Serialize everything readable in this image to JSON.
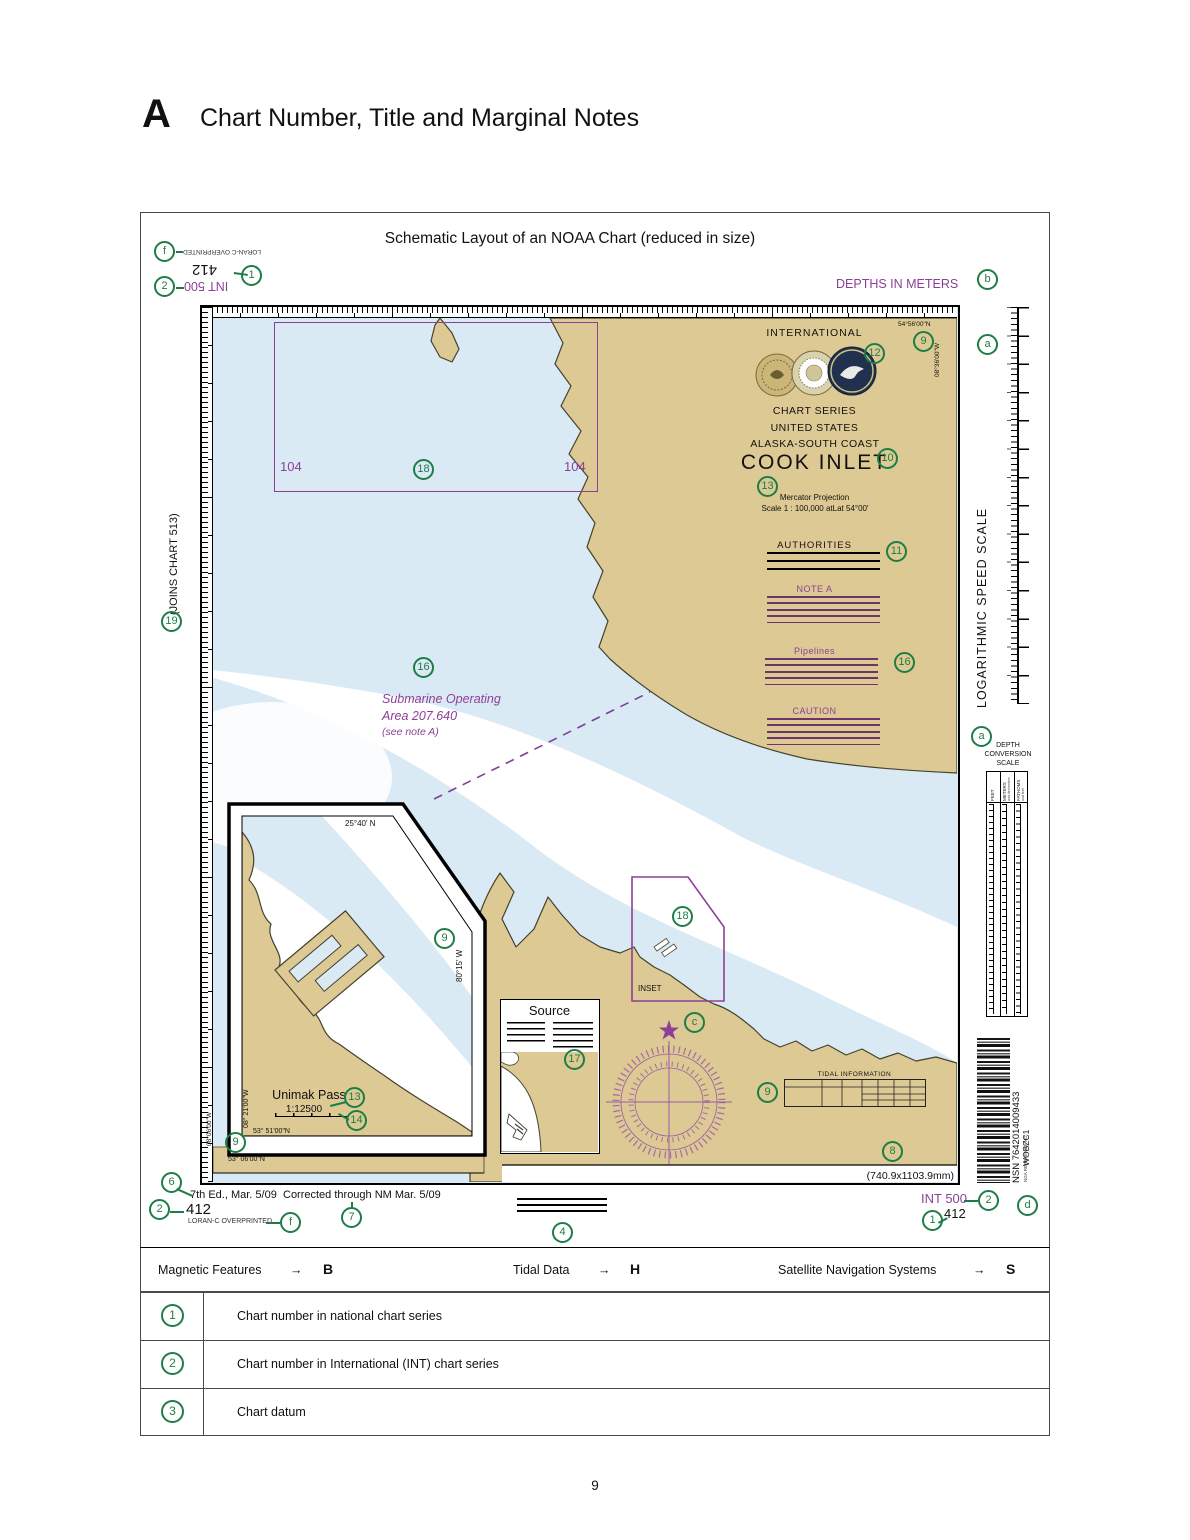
{
  "colors": {
    "green": "#1e7d46",
    "purple": "#8d3f97",
    "note_line": "#6d3468",
    "land": "#ddc994",
    "water": "#d9eaf4"
  },
  "header": {
    "section_letter": "A",
    "section_title": "Chart Number, Title and Marginal Notes"
  },
  "figure": {
    "title": "Schematic Layout of an NOAA Chart (reduced in size)"
  },
  "callouts": {
    "f": "f",
    "b": "b",
    "a": "a",
    "c": "c",
    "d": "d",
    "n1": "1",
    "n2": "2",
    "n4": "4",
    "n6": "6",
    "n7": "7",
    "n8": "8",
    "n9": "9",
    "n10": "10",
    "n11": "11",
    "n12": "12",
    "n13": "13",
    "n14": "14",
    "n16": "16",
    "n17": "17",
    "n18": "18",
    "n19": "19"
  },
  "top_left": {
    "loran": "LORAN-C OVERPRINTED",
    "chart_number": "412",
    "int_number": "INT 500"
  },
  "top_right": {
    "depths": "DEPTHS IN METERS"
  },
  "left_margin": {
    "joins": "(JOINS CHART 513)"
  },
  "right_margin": {
    "speed_scale": "LOGARITHMIC SPEED SCALE",
    "depth_scale_line1": "DEPTH",
    "depth_scale_line2": "CONVERSION",
    "depth_scale_line3": "SCALE",
    "col_feet": "FEET",
    "col_meters": "METERS",
    "col_meters_sub": "and decimeters",
    "col_fathoms": "FATHOMS",
    "col_fathoms_sub": "and feet"
  },
  "title_block": {
    "international": "INTERNATIONAL",
    "lat_top": "54°56'00\"N",
    "lon_right": "08°36'00\"W",
    "chart_series": "CHART SERIES",
    "united_states": "UNITED STATES",
    "region": "ALASKA-SOUTH COAST",
    "chart_title": "COOK INLET",
    "projection": "Mercator Projection",
    "scale": "Scale 1 : 100,000 atLat 54°00'"
  },
  "notes": {
    "authorities": "AUTHORITIES",
    "note_a": "NOTE A",
    "pipelines": "Pipelines",
    "caution": "CAUTION"
  },
  "map": {
    "neatline_number": "104",
    "submarine_line1": "Submarine Operating",
    "submarine_line2": "Area  207.640",
    "submarine_line3": "(see note A)",
    "inset_frame_label": "INSET",
    "source_title": "Source",
    "tidal_title": "TIDAL INFORMATION",
    "dimensions": "(740.9x1103.9mm)"
  },
  "inset": {
    "lat_top": "25°40' N",
    "lon_right": "80°15' W",
    "name": "Unimak Pass",
    "scale": "1:12500",
    "lon_left": "08° 21'00\"W",
    "lat_bottom": "53° 51'00\"N",
    "corner_lon": "08°06'00\"W",
    "corner_lat": "53° 06'00\"N"
  },
  "barcode": {
    "nsn": "NSN 7642014009433",
    "nga_label": "NGA REFERENCE NO.",
    "nga_value": "WOBZC1"
  },
  "bottom_left": {
    "edition": "7th Ed., Mar. 5/09",
    "corrected": "Corrected through NM Mar. 5/09",
    "chart_number": "412",
    "loran": "LORAN-C OVERPRINTED"
  },
  "bottom_right": {
    "int_number": "INT 500",
    "chart_number": "412"
  },
  "legend_bar": [
    {
      "label": "Magnetic Features",
      "arrow": "→",
      "ref": "B"
    },
    {
      "label": "Tidal Data",
      "arrow": "→",
      "ref": "H"
    },
    {
      "label": "Satellite Navigation Systems",
      "arrow": "→",
      "ref": "S"
    }
  ],
  "reference_table": [
    {
      "num": "1",
      "desc": "Chart number in national chart series"
    },
    {
      "num": "2",
      "desc": "Chart number in International (INT) chart series"
    },
    {
      "num": "3",
      "desc": "Chart datum"
    }
  ],
  "page_number": "9"
}
